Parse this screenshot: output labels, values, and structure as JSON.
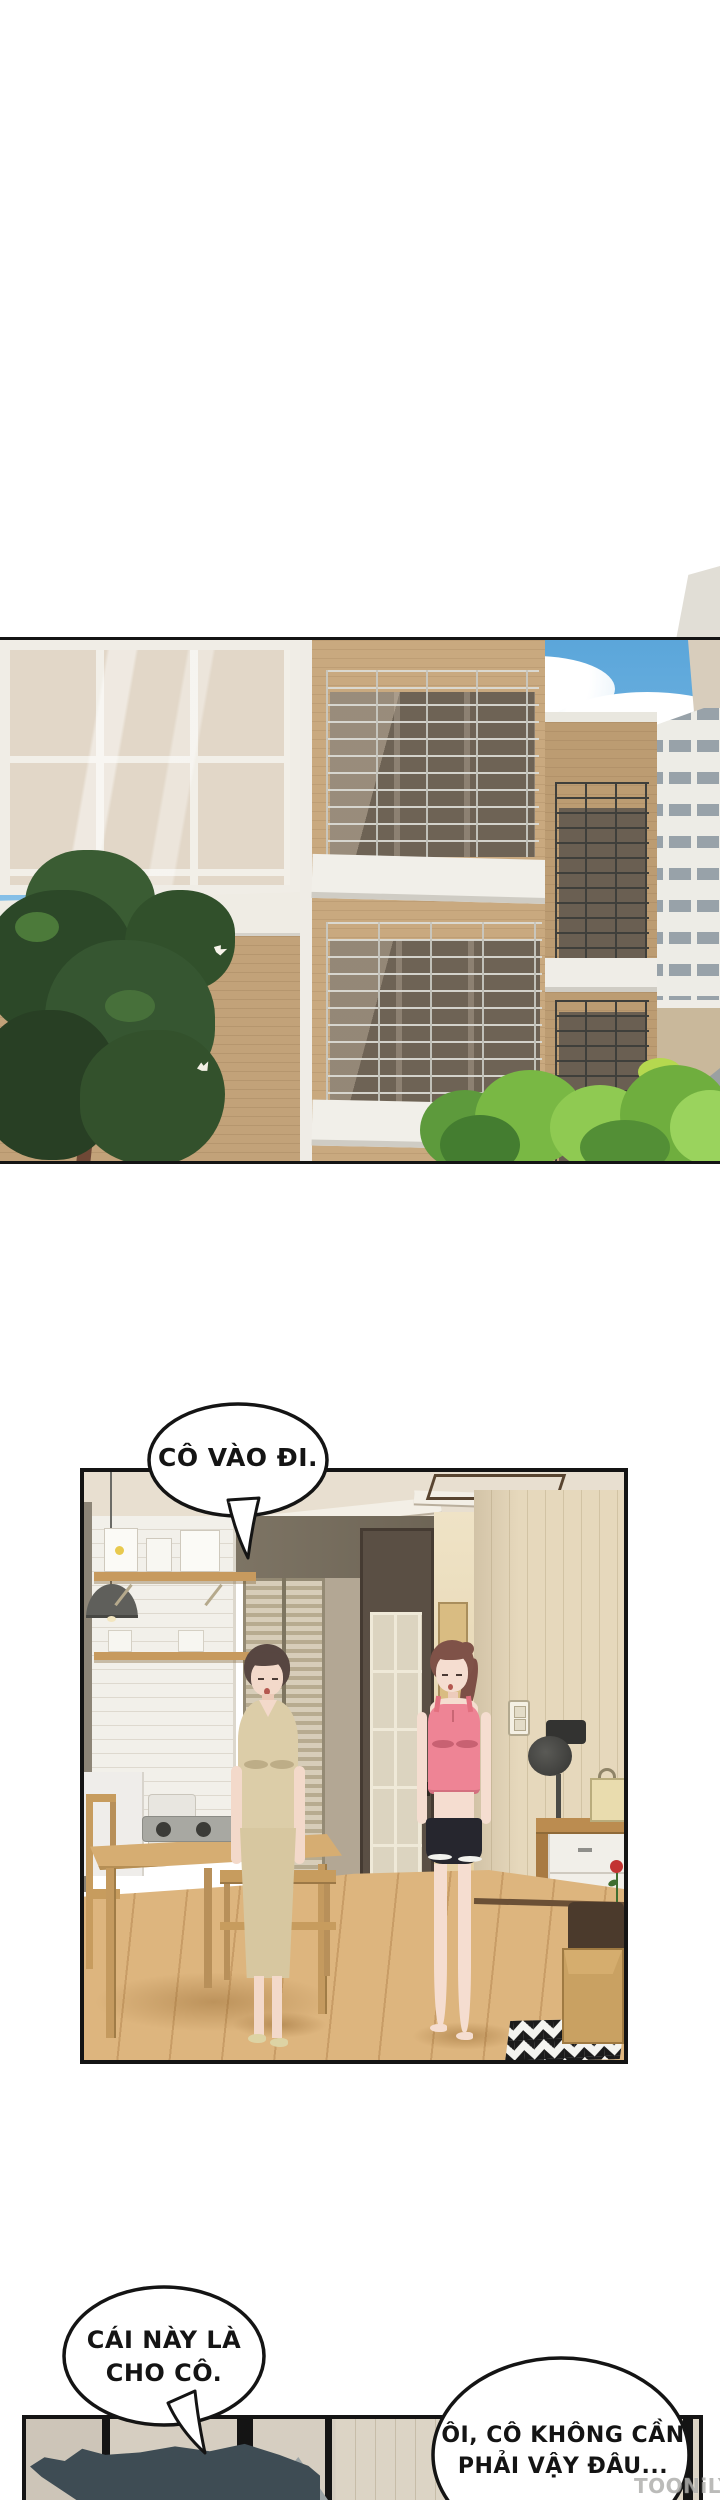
{
  "bubbles": {
    "enter": {
      "text": "CÔ VÀO ĐI."
    },
    "gift": {
      "line1": "CÁI NÀY LÀ",
      "line2": "CHO CÔ."
    },
    "reply": {
      "line1": "ÔI, CÔ KHÔNG CẦN",
      "line2": "PHẢI VẬY ĐÂU..."
    }
  },
  "watermark": {
    "text": "TOONiLY"
  },
  "colors": {
    "panel_border": "#141414",
    "sky": "#5ba6da",
    "brick": "#c9a97f",
    "trim_white": "#efece6",
    "foliage": "#2c4828",
    "bush_green": "#79b844",
    "ceiling": "#e8dfd0",
    "brick_wall_white": "#f2f0ea",
    "right_wall": "#e6d8bc",
    "floor": "#ddb57e",
    "dress_beige": "#dccda8",
    "top_pink": "#ee8495",
    "shorts_black": "#26262e",
    "fish": "#3e4c54"
  }
}
